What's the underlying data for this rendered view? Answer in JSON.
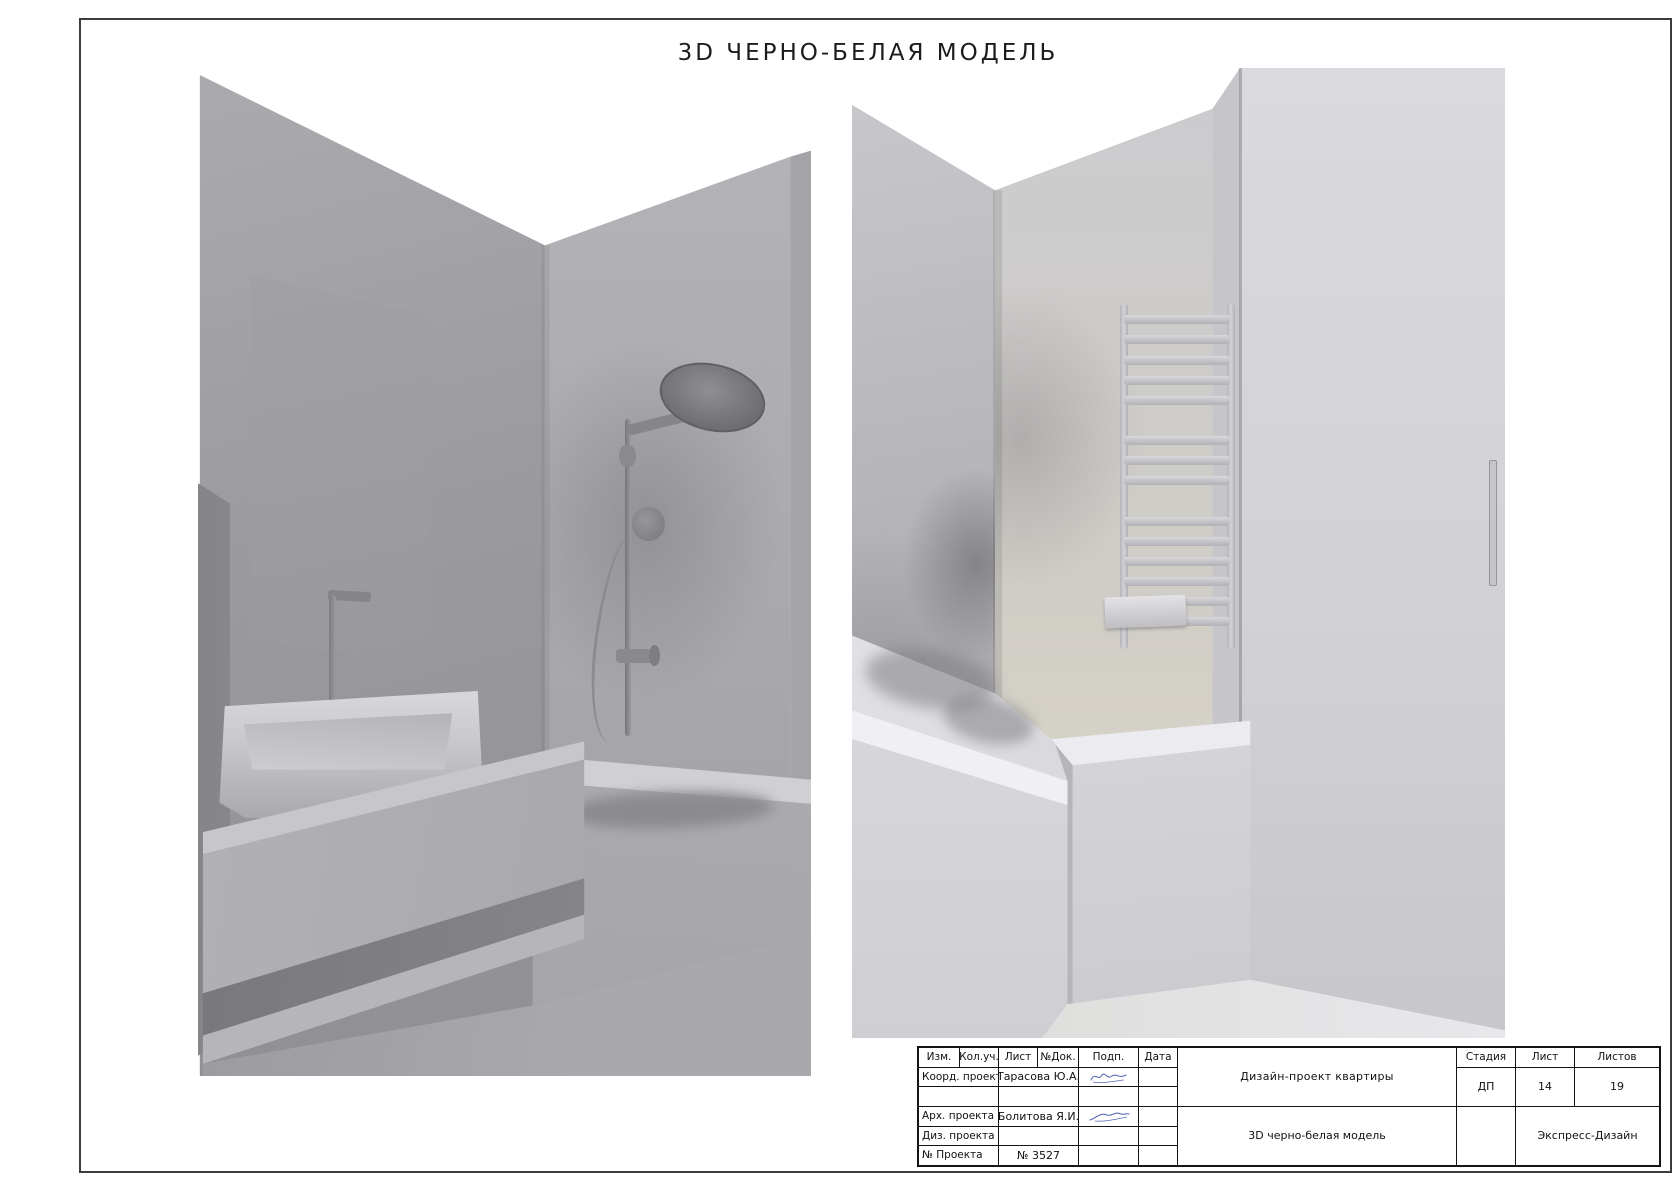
{
  "sheet": {
    "title": "3D ЧЕРНО-БЕЛАЯ МОДЕЛЬ"
  },
  "stamp": {
    "header_cols": [
      "Изм.",
      "Кол.уч.",
      "Лист",
      "№Док.",
      "Подп.",
      "Дата"
    ],
    "row_coord_label": "Коорд. проекта",
    "row_coord_value": "Тарасова Ю.А.",
    "row_arch_label": "Арх. проекта",
    "row_arch_value": "Болитова Я.И.",
    "row_diz_label": "Диз. проекта",
    "row_num_label": "№ Проекта",
    "row_num_value": "№ 3527",
    "project_title": "Дизайн-проект квартиры",
    "sheet_title": "3D черно-белая модель",
    "stage_label": "Стадия",
    "sheet_label": "Лист",
    "sheets_label": "Листов",
    "stage_value": "ДП",
    "sheet_value": "14",
    "sheets_value": "19",
    "company": "Экспресс-Дизайн",
    "brand_color": "#2aa9e0"
  }
}
